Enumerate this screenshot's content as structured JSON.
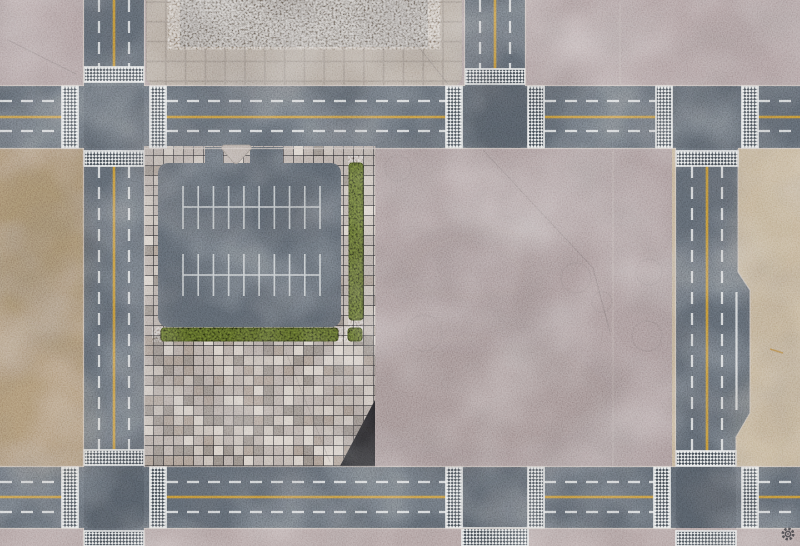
{
  "scene": {
    "title": "top-down city gaming mat with roads, parking lot and plaza",
    "viewBox": "0 0 800 546",
    "width": 800,
    "height": 546
  },
  "palette": {
    "concrete_top": "#ab9b9c",
    "concrete_mid": "#a59596",
    "bottom_walk": "#ae9e9e",
    "dirt_left": "#a58d6f",
    "sand_right": "#bfae93",
    "asphalt": "#59616a",
    "asphalt_parking": "#575f68",
    "intersection_tint": "#3f474f",
    "paver_base": "#b3a9a3",
    "paver_light": "#d5cdc5",
    "paver_midlight": "#c3bab2",
    "paver_dark": "#8f867f",
    "paver_brown": "#a4968b",
    "apron_tile": "#b1a79d",
    "apron_grout": "#9c9289",
    "pad_concrete": "#96908a",
    "hedge": "#46511f",
    "hedge_dark": "#2f3812",
    "line_white": "#d9dcde",
    "line_yellow": "#c28f33",
    "crosswalk_white": "#e8eaea",
    "crosswalk_dark": "#3e464e",
    "curb": "#cfc6c0",
    "crack": "#3a3436",
    "joint_light": "#c9c0ba",
    "rust": "#b07830",
    "logo_color": "#45454a"
  },
  "ground_regions": [
    {
      "name": "sidewalk-top-strip",
      "fill": "concrete_top",
      "rect": [
        0,
        0,
        800,
        86
      ]
    },
    {
      "name": "dirt-lot-left",
      "fill": "dirt_left",
      "rect": [
        0,
        148,
        84,
        319
      ]
    },
    {
      "name": "concrete-plaza-middle",
      "fill": "concrete_mid",
      "rect": [
        375,
        148,
        301,
        319
      ]
    },
    {
      "name": "sand-strip-right",
      "fill": "sand_right",
      "rect": [
        672,
        148,
        128,
        319
      ]
    },
    {
      "name": "sidewalk-bottom-strip",
      "fill": "bottom_walk",
      "rect": [
        0,
        528,
        800,
        18
      ]
    }
  ],
  "roads": {
    "rects": [
      {
        "name": "road-top",
        "rect": [
          0,
          86,
          800,
          62
        ]
      },
      {
        "name": "road-bottom",
        "rect": [
          0,
          467,
          800,
          61
        ]
      },
      {
        "name": "road-left",
        "rect": [
          84,
          0,
          60,
          546
        ]
      },
      {
        "name": "road-stub-top",
        "rect": [
          465,
          0,
          60,
          86
        ]
      }
    ],
    "right_road_points": "676,148 738,148 738,272 750,290 750,413 736,437 736,467 676,467",
    "right_curb_points": "738,149 738,272 750,290 750,413 736,437 736,466"
  },
  "intersections": [
    [
      84,
      86,
      60,
      62
    ],
    [
      462,
      86,
      66,
      62
    ],
    [
      672,
      86,
      70,
      62
    ],
    [
      84,
      467,
      60,
      61
    ],
    [
      462,
      467,
      66,
      61
    ],
    [
      676,
      467,
      60,
      61
    ]
  ],
  "apron": {
    "rect": [
      146,
      -8,
      316,
      94
    ],
    "tile": 19.8
  },
  "pad": {
    "rect": [
      180,
      0,
      248,
      47
    ]
  },
  "paver_block": {
    "x0": 144,
    "x1": 376,
    "y0": 146,
    "y1": 466,
    "tile": 10,
    "seed": 1337,
    "clip_points": "144,146 376,146 376,398 340,466 144,466",
    "plaza_from_y": 332,
    "weights_border": {
      "paver_base": 0.58,
      "paver_midlight": 0.18,
      "paver_light": 0.09,
      "paver_dark": 0.1,
      "paver_brown": 0.05
    },
    "weights_plaza": {
      "paver_base": 0.3,
      "paver_midlight": 0.2,
      "paver_light": 0.17,
      "paver_dark": 0.19,
      "paver_brown": 0.14
    }
  },
  "parking": {
    "lot": [
      158,
      163,
      183,
      164
    ],
    "entrances": [
      [
        205,
        147,
        18,
        20
      ],
      [
        250,
        147,
        33,
        20
      ]
    ],
    "island_path": "M224,145 L249,145 Q252,146 251,149 L239,162 Q236,165 233,162 L222,149 Q221,146 224,145 Z",
    "combs": [
      {
        "x1": 183,
        "x2": 320,
        "line_y": 207,
        "tick_top": 186,
        "tick_bottom": 229,
        "ticks": 10
      },
      {
        "x1": 183,
        "x2": 320,
        "line_y": 275,
        "tick_top": 254,
        "tick_bottom": 296,
        "ticks": 10
      }
    ]
  },
  "hedges": [
    [
      349,
      163,
      14,
      157
    ],
    [
      161,
      328,
      177,
      13
    ],
    [
      348,
      328,
      14,
      13
    ]
  ],
  "lane_markings": {
    "dash": "12 9",
    "white_dashed": [
      [
        0,
        101,
        62,
        101
      ],
      [
        166,
        101,
        446,
        101
      ],
      [
        544,
        101,
        656,
        101
      ],
      [
        758,
        101,
        800,
        101
      ],
      [
        0,
        131,
        62,
        131
      ],
      [
        166,
        131,
        446,
        131
      ],
      [
        544,
        131,
        656,
        131
      ],
      [
        758,
        131,
        800,
        131
      ],
      [
        0,
        482,
        62,
        482
      ],
      [
        166,
        482,
        446,
        482
      ],
      [
        544,
        482,
        654,
        482
      ],
      [
        758,
        482,
        800,
        482
      ],
      [
        0,
        512,
        62,
        512
      ],
      [
        166,
        512,
        446,
        512
      ],
      [
        544,
        512,
        654,
        512
      ],
      [
        758,
        512,
        800,
        512
      ],
      [
        99,
        0,
        99,
        67
      ],
      [
        129,
        0,
        129,
        67
      ],
      [
        99,
        166,
        99,
        450
      ],
      [
        129,
        166,
        129,
        450
      ],
      [
        480,
        0,
        480,
        69
      ],
      [
        510,
        0,
        510,
        69
      ],
      [
        692,
        166,
        692,
        451
      ],
      [
        722,
        166,
        722,
        451
      ]
    ],
    "yellow": [
      [
        0,
        117,
        62,
        117
      ],
      [
        166,
        117,
        446,
        117
      ],
      [
        544,
        117,
        656,
        117
      ],
      [
        758,
        117,
        800,
        117
      ],
      [
        0,
        497,
        62,
        497
      ],
      [
        166,
        497,
        446,
        497
      ],
      [
        544,
        497,
        654,
        497
      ],
      [
        758,
        497,
        800,
        497
      ],
      [
        114,
        0,
        114,
        67
      ],
      [
        114,
        166,
        114,
        450
      ],
      [
        495,
        0,
        495,
        69
      ],
      [
        707,
        166,
        707,
        451
      ]
    ],
    "white_solid": [
      [
        736.5,
        292,
        736.5,
        410
      ]
    ]
  },
  "crosswalks": [
    [
      62,
      86,
      16,
      62
    ],
    [
      150,
      86,
      16,
      62
    ],
    [
      446,
      86,
      16,
      62
    ],
    [
      528,
      86,
      16,
      62
    ],
    [
      656,
      86,
      16,
      62
    ],
    [
      742,
      86,
      16,
      62
    ],
    [
      62,
      467,
      16,
      61
    ],
    [
      150,
      467,
      16,
      61
    ],
    [
      446,
      467,
      16,
      61
    ],
    [
      528,
      467,
      16,
      61
    ],
    [
      654,
      467,
      16,
      61
    ],
    [
      742,
      467,
      16,
      61
    ],
    [
      84,
      67,
      60,
      15
    ],
    [
      84,
      151,
      60,
      15
    ],
    [
      84,
      450,
      60,
      15
    ],
    [
      84,
      531,
      60,
      15
    ],
    [
      465,
      69,
      60,
      15
    ],
    [
      676,
      151,
      62,
      15
    ],
    [
      676,
      451,
      60,
      15
    ],
    [
      676,
      531,
      60,
      15
    ],
    [
      462,
      528,
      66,
      18
    ]
  ],
  "curb_lines": [
    [
      0,
      85.5,
      84,
      85.5
    ],
    [
      144,
      85.5,
      465,
      85.5
    ],
    [
      525,
      85.5,
      800,
      85.5
    ],
    [
      0,
      148.5,
      84,
      148.5
    ],
    [
      144,
      148.5,
      676,
      148.5
    ],
    [
      738,
      148.5,
      800,
      148.5
    ],
    [
      0,
      466.5,
      84,
      466.5
    ],
    [
      144,
      466.5,
      676,
      466.5
    ],
    [
      736,
      466.5,
      800,
      466.5
    ],
    [
      0,
      528.5,
      84,
      528.5
    ],
    [
      144,
      528.5,
      676,
      528.5
    ],
    [
      736,
      528.5,
      800,
      528.5
    ],
    [
      83.5,
      0,
      83.5,
      86
    ],
    [
      83.5,
      148,
      83.5,
      467
    ],
    [
      83.5,
      528,
      83.5,
      546
    ],
    [
      144.5,
      0,
      144.5,
      86
    ],
    [
      144.5,
      148,
      144.5,
      467
    ],
    [
      144.5,
      528,
      144.5,
      546
    ],
    [
      464.5,
      0,
      464.5,
      86
    ],
    [
      525.5,
      0,
      525.5,
      86
    ],
    [
      675.5,
      148,
      675.5,
      467
    ]
  ],
  "cracks": [
    [
      410,
      36,
      448,
      84
    ],
    [
      483,
      150,
      593,
      268
    ],
    [
      593,
      268,
      610,
      332
    ],
    [
      286,
      352,
      330,
      462
    ],
    [
      8,
      40,
      76,
      74
    ]
  ],
  "joints": [
    [
      620,
      2,
      620,
      84
    ],
    [
      613,
      150,
      613,
      465
    ]
  ],
  "stain_rings": [
    [
      398,
      168,
      13
    ],
    [
      576,
      278,
      15
    ],
    [
      649,
      272,
      13
    ],
    [
      647,
      336,
      15
    ],
    [
      424,
      333,
      18
    ],
    [
      602,
      302,
      10
    ]
  ],
  "stains": [
    [
      560,
      200,
      110,
      50,
      "#ffffff",
      0.1
    ],
    [
      610,
      35,
      70,
      26,
      "#ffffff",
      0.12
    ],
    [
      470,
      250,
      90,
      45,
      "#ffffff",
      0.06
    ],
    [
      465,
      280,
      75,
      60,
      "#70605f",
      0.12
    ],
    [
      480,
      395,
      150,
      75,
      "#6e5e5d",
      0.1
    ],
    [
      240,
      400,
      90,
      50,
      "#8a7d73",
      0.08
    ],
    [
      40,
      260,
      55,
      90,
      "#6b5a42",
      0.14
    ],
    [
      50,
      420,
      50,
      60,
      "#c2aa85",
      0.12
    ],
    [
      772,
      230,
      40,
      70,
      "#a08a66",
      0.1
    ],
    [
      768,
      420,
      40,
      50,
      "#cbbb9e",
      0.12
    ],
    [
      300,
      70,
      80,
      30,
      "#8f857c",
      0.08
    ]
  ],
  "rust_mark": [
    770,
    349,
    783,
    353
  ],
  "logo": {
    "cx": 788,
    "cy": 534,
    "r": 5.2
  }
}
